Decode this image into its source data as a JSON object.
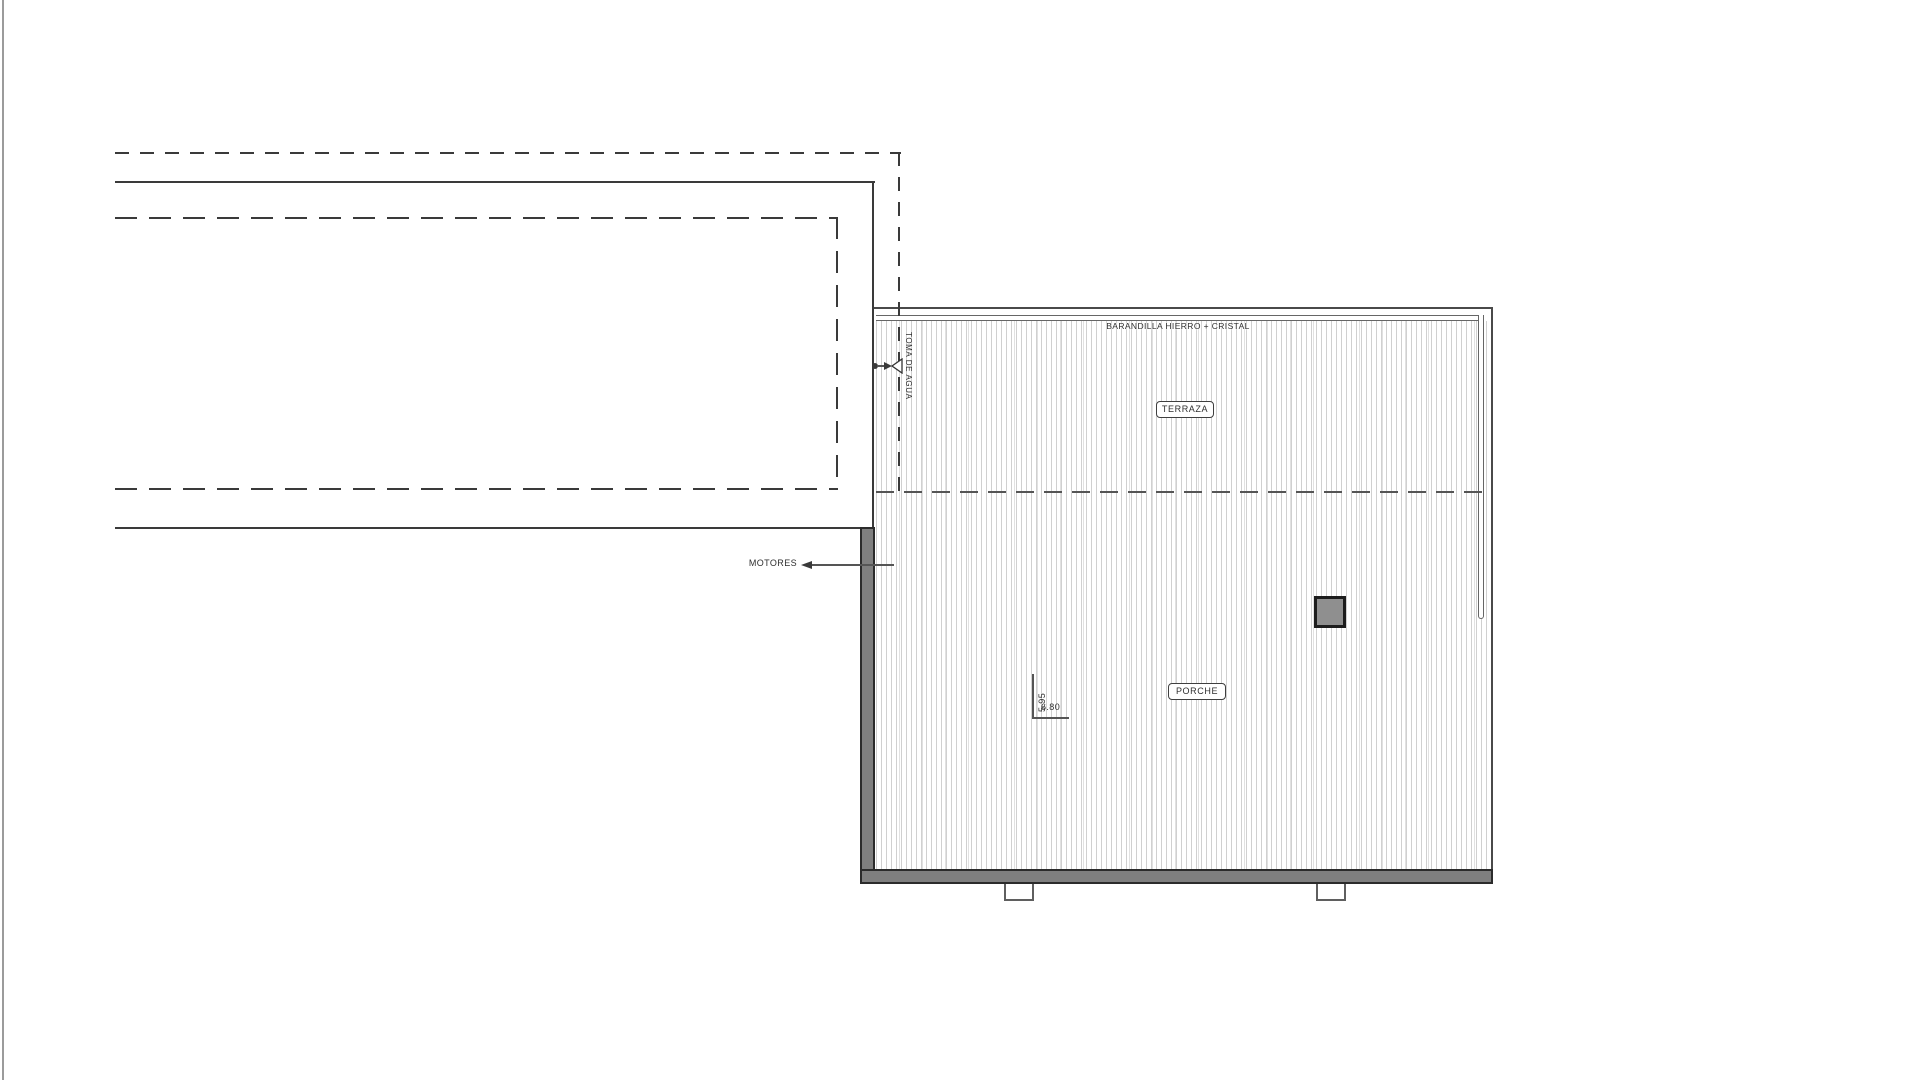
{
  "page": {
    "background": "#ffffff",
    "edge_line_color": "#9b9b9b"
  },
  "plan": {
    "labels": {
      "barandilla": "BARANDILLA HIERRO + CRISTAL",
      "terraza": "TERRAZA",
      "porche": "PORCHE",
      "toma_de_agua": "TOMA DE AGUA",
      "motores": "MOTORES"
    },
    "dimensions": {
      "depth": "5.95",
      "width": "6.80"
    },
    "colors": {
      "line_dark": "#3a3a3a",
      "line_mid": "#666666",
      "leader": "#555555",
      "wall_fill": "#7f7f7f",
      "wall_outline": "#2b2b2b",
      "pillar_fill": "#8f8f8f",
      "pillar_outline": "#1d1d1d",
      "hatch_line": "#d0d0d0",
      "footing_border": "#5f5f5f",
      "background": "#ffffff"
    }
  }
}
